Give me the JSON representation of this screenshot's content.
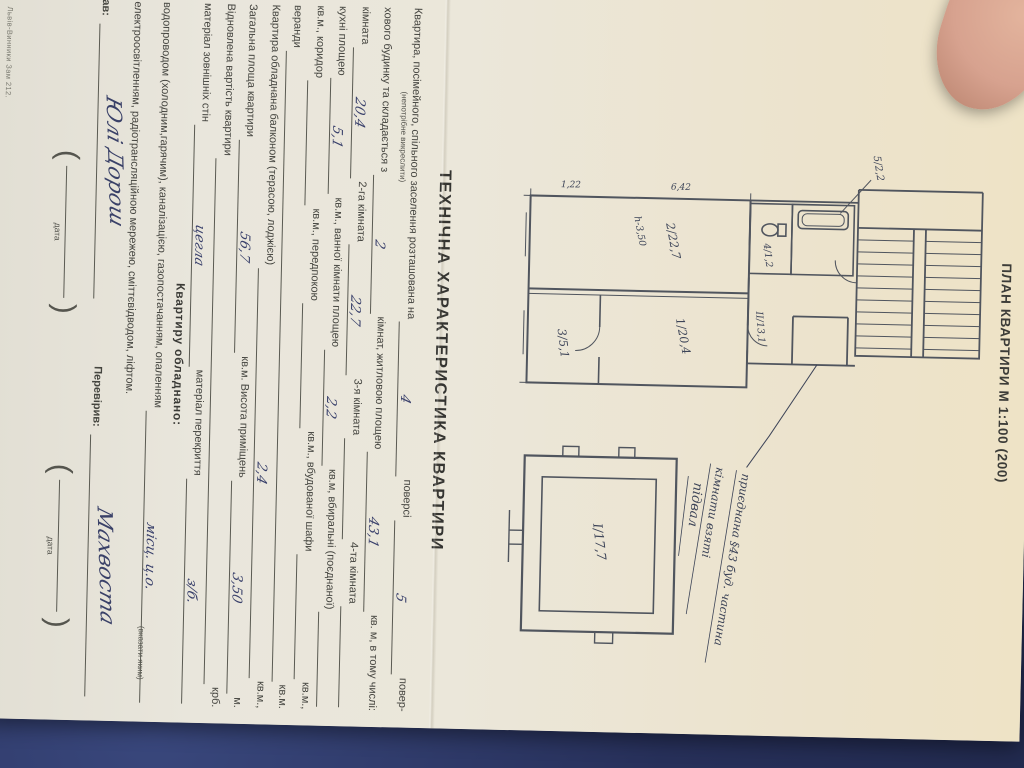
{
  "page": {
    "plan_title": "ПЛАН КВАРТИРИ М 1:100 (200)",
    "section_title": "ТЕХНІЧНА ХАРАКТЕРИСТИКА КВАРТИРИ",
    "equipped_title": "Квартиру обладнано:",
    "note_strike": "(непотрібне викреслити)",
    "note_indicate": "(вказати яким)",
    "date_label": "дата",
    "imprint": "Львів-Винники Зам 212.",
    "made_by_label": "Склав:",
    "made_by_signature": "Юлі Дорош",
    "checked_by_label": "Перевірив:",
    "checked_by_signature": "Махвоста",
    "plan": {
      "rooms": [
        {
          "label": "2/22,7"
        },
        {
          "label": "1/20,4"
        },
        {
          "label": "3/5,1"
        },
        {
          "label": "4/1,2"
        },
        {
          "label": "5/2,2"
        },
        {
          "label": "ІІ/13,1"
        },
        {
          "label": "І/17,7"
        }
      ],
      "height_note": "h-3,50",
      "dims": [
        "6,42",
        "1,22"
      ],
      "handwritten_basement": "підвал",
      "annotation_line1": "приєднана §43 буд. частина",
      "annotation_line2": "кімнати взяті"
    },
    "form_lines": [
      {
        "segments": [
          {
            "t": "Квартира, посімейного, спільного заселення розташована на"
          },
          {
            "b": "4",
            "w": 55
          },
          {
            "t": "поверсі"
          },
          {
            "b": "5",
            "w": 70
          },
          {
            "t": "повер-"
          }
        ]
      },
      {
        "segments": [
          {
            "t": "хового будинку та складається з"
          },
          {
            "b": "2",
            "w": 70
          },
          {
            "t": "кімнат, житловою площею"
          },
          {
            "b": "43,1",
            "w": 60
          },
          {
            "t": "кв. м, в тому числі:"
          }
        ]
      },
      {
        "segments": [
          {
            "t": "кімната"
          },
          {
            "b": "20,4",
            "w": 70
          },
          {
            "t": "2-га кімната"
          },
          {
            "b": "22,7",
            "w": 75
          },
          {
            "t": "3-я кімната"
          },
          {
            "b": "",
            "w": 70
          },
          {
            "t": "4-та кімната"
          },
          {
            "b": "",
            "w": 55
          }
        ]
      },
      {
        "segments": [
          {
            "t": "кухні площею"
          },
          {
            "b": "5,1",
            "w": 55
          },
          {
            "t": "кв.м., ванної кімнати площею"
          },
          {
            "b": "2,2",
            "w": 55
          },
          {
            "t": "кв.м, вбиральні (поєднаної)"
          },
          {
            "b": "",
            "w": 35
          }
        ]
      },
      {
        "segments": [
          {
            "t": "кв.м., коридор"
          },
          {
            "b": "",
            "w": 75
          },
          {
            "t": "кв.м., передпокою"
          },
          {
            "b": "",
            "w": 75
          },
          {
            "t": "кв.м., вбудованої шафи"
          },
          {
            "b": "",
            "w": 45
          },
          {
            "t": "кв.м.,"
          }
        ]
      },
      {
        "segments": [
          {
            "t": "веранди"
          },
          {
            "b": "",
            "w": 120
          },
          {
            "t": "кв.м."
          }
        ]
      },
      {
        "segments": [
          {
            "t": "Квартира обладнана балконом (терасою, лоджією)"
          },
          {
            "b": "2,4",
            "w": 160
          },
          {
            "t": "кв.м.,"
          }
        ]
      },
      {
        "segments": [
          {
            "t": "Загальна площа квартири"
          },
          {
            "b": "56,7",
            "w": 150
          },
          {
            "t": "кв.м. Висота приміщень"
          },
          {
            "b": "3,50",
            "w": 85
          },
          {
            "t": "м."
          }
        ]
      },
      {
        "segments": [
          {
            "t": "Відновлена вартість квартири"
          },
          {
            "b": "",
            "w": 300
          },
          {
            "t": "крб."
          }
        ]
      },
      {
        "segments": [
          {
            "t": "матеріал зовнішніх стін"
          },
          {
            "b": "цегла",
            "w": 200
          },
          {
            "t": "матеріал перекриття"
          },
          {
            "b": "з/б.",
            "w": 120
          }
        ]
      },
      {
        "segments": [
          {
            "t": "водопроводом (холодним,гарячим), каналізацією, газопостачанням, опаленням"
          },
          {
            "b": "місц. ц.о.",
            "w": 70
          }
        ]
      },
      {
        "segments": [
          {
            "t": "електроосвітленням, радіотрансляційною мережею, сміттєвідводом, ліфтом."
          }
        ]
      }
    ]
  }
}
